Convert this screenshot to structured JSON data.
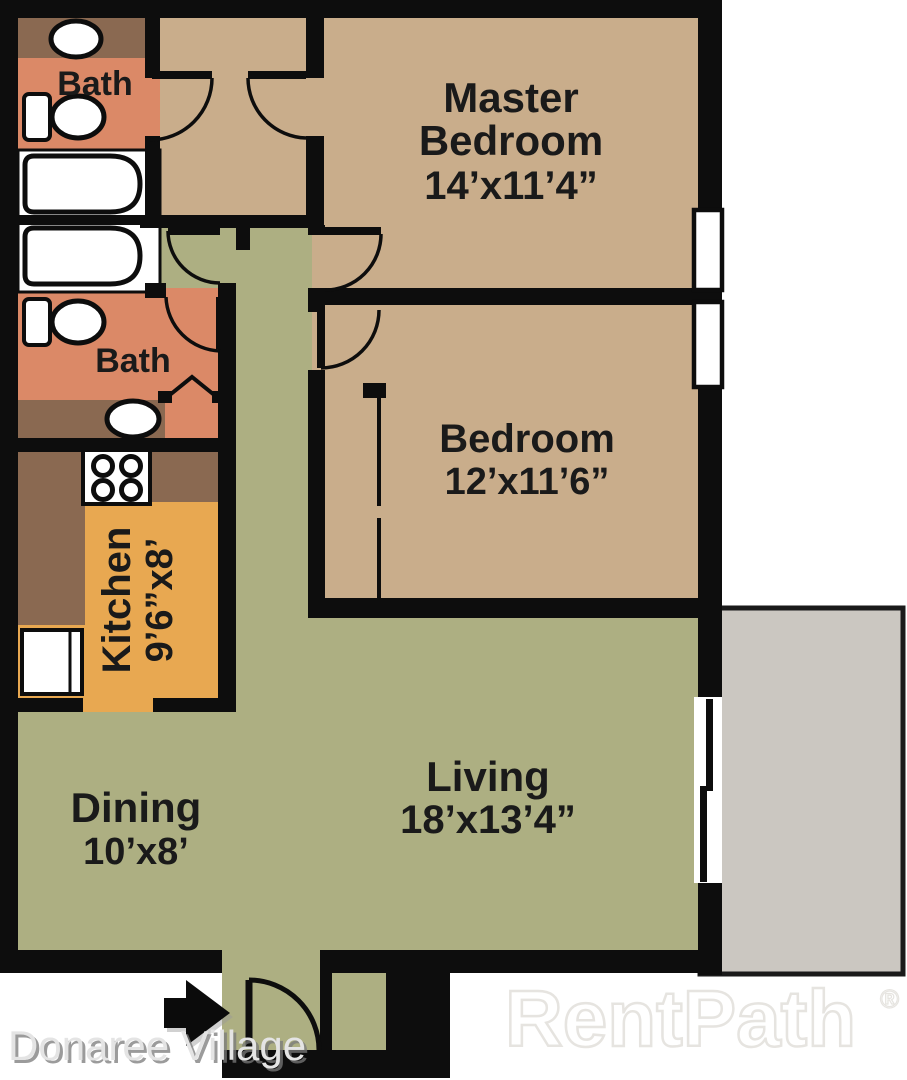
{
  "floor_plan": {
    "rooms": {
      "master_bedroom": {
        "label_line1": "Master",
        "label_line2": "Bedroom",
        "dimensions": "14’x11’4”"
      },
      "bedroom": {
        "label": "Bedroom",
        "dimensions": "12’x11’6”"
      },
      "bath_top": {
        "label": "Bath"
      },
      "bath_middle": {
        "label": "Bath"
      },
      "kitchen": {
        "label": "Kitchen",
        "dimensions": "9’6”x8’"
      },
      "living": {
        "label": "Living",
        "dimensions": "18’x13’4”"
      },
      "dining": {
        "label": "Dining",
        "dimensions": "10’x8’"
      }
    },
    "icons": {
      "entry_arrow": "entry-direction-arrow",
      "fixtures": [
        "toilet",
        "toilet",
        "bathtub",
        "bathtub",
        "sink",
        "sink",
        "stove",
        "refrigerator"
      ]
    }
  },
  "branding": {
    "property_name": "Donaree Village",
    "watermark": "RentPath",
    "registered_mark": "®"
  },
  "colors": {
    "wall": "#0d0d0d",
    "room_tan": "#c9ad8b",
    "bath_salmon": "#db8967",
    "cabinet_brown": "#8a6951",
    "kitchen_orange": "#e8a851",
    "living_green": "#adaf82",
    "patio_gray": "#cbc7c1",
    "fixture_white": "#ffffff",
    "label": "#1a1a1a"
  }
}
